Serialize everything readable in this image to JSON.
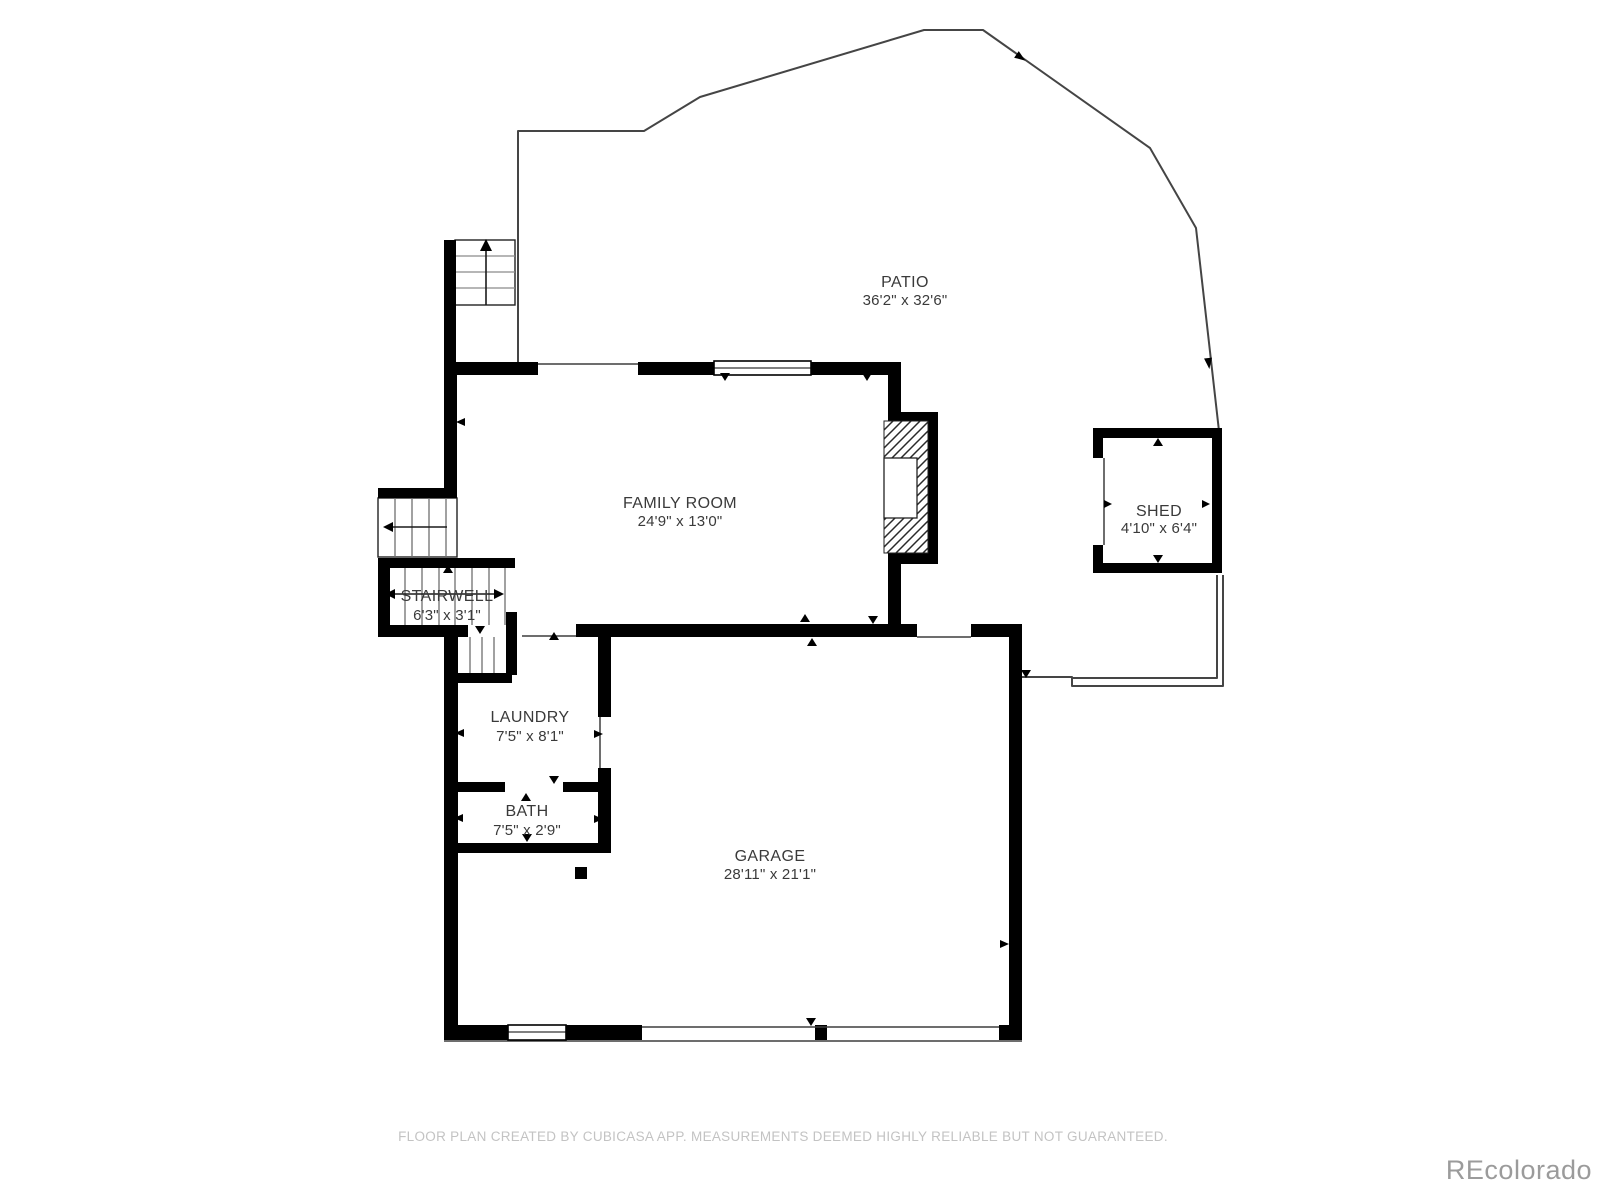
{
  "page": {
    "footer": "FLOOR PLAN CREATED BY CUBICASA APP. MEASUREMENTS DEEMED HIGHLY RELIABLE BUT NOT GUARANTEED.",
    "watermark": "REcolorado"
  },
  "rooms": {
    "patio": {
      "name": "PATIO",
      "dims": "36'2\" x 32'6\""
    },
    "family_room": {
      "name": "FAMILY ROOM",
      "dims": "24'9\" x 13'0\""
    },
    "shed": {
      "name": "SHED",
      "dims": "4'10\" x 6'4\""
    },
    "stairwell": {
      "name": "STAIRWELL",
      "dims": "6'3\" x 3'1\""
    },
    "laundry": {
      "name": "LAUNDRY",
      "dims": "7'5\" x 8'1\""
    },
    "bath": {
      "name": "BATH",
      "dims": "7'5\" x 2'9\""
    },
    "garage": {
      "name": "GARAGE",
      "dims": "28'11\" x 21'1\""
    }
  },
  "colors": {
    "wall": "#000000",
    "thin_line": "#3d3d3d",
    "patio_boundary": "#454545",
    "label_text": "#3a3a3a",
    "footer_text": "#c3c3c3",
    "watermark_text": "#9b9b9b",
    "background": "#ffffff"
  }
}
